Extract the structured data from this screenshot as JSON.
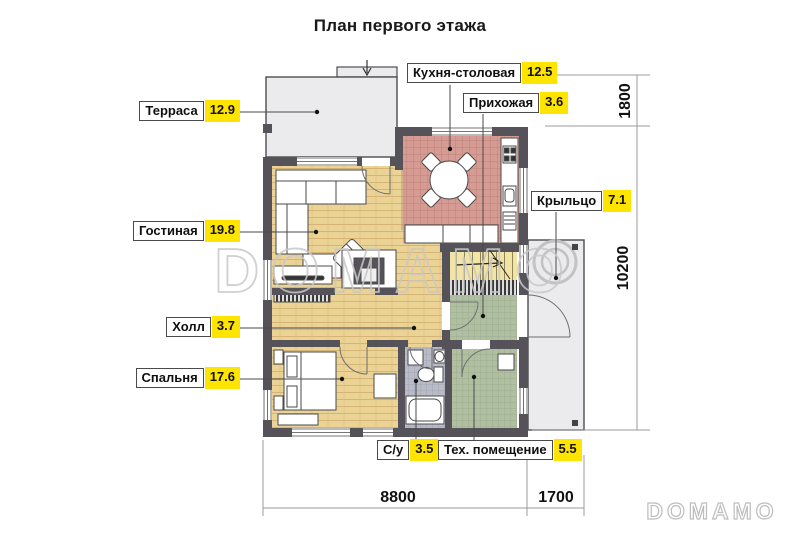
{
  "title": "План первого этажа",
  "rooms": [
    {
      "name": "Терраса",
      "area": "12.9"
    },
    {
      "name": "Кухня-столовая",
      "area": "12.5"
    },
    {
      "name": "Прихожая",
      "area": "3.6"
    },
    {
      "name": "Крыльцо",
      "area": "7.1"
    },
    {
      "name": "Гостиная",
      "area": "19.8"
    },
    {
      "name": "Холл",
      "area": "3.7"
    },
    {
      "name": "Спальня",
      "area": "17.6"
    },
    {
      "name": "С/у",
      "area": "3.5"
    },
    {
      "name": "Тех. помещение",
      "area": "5.5"
    }
  ],
  "dimensions": {
    "terrace_depth": "1800",
    "house_depth": "10200",
    "house_width": "8800",
    "porch_width": "1700"
  },
  "watermark": {
    "center": "DOMAMO",
    "corner": "DOMAMO"
  },
  "colors": {
    "area_highlight": "#FFE400",
    "wall": "#55525A",
    "kitchen_floor": "#D69B93",
    "wood_floor": "#EBD395",
    "stairs_floor": "#F2E4A4",
    "green_tile": "#B1BFA1",
    "gray_tile": "#B9BCC6",
    "terrace_fill": "#EBEBED"
  }
}
